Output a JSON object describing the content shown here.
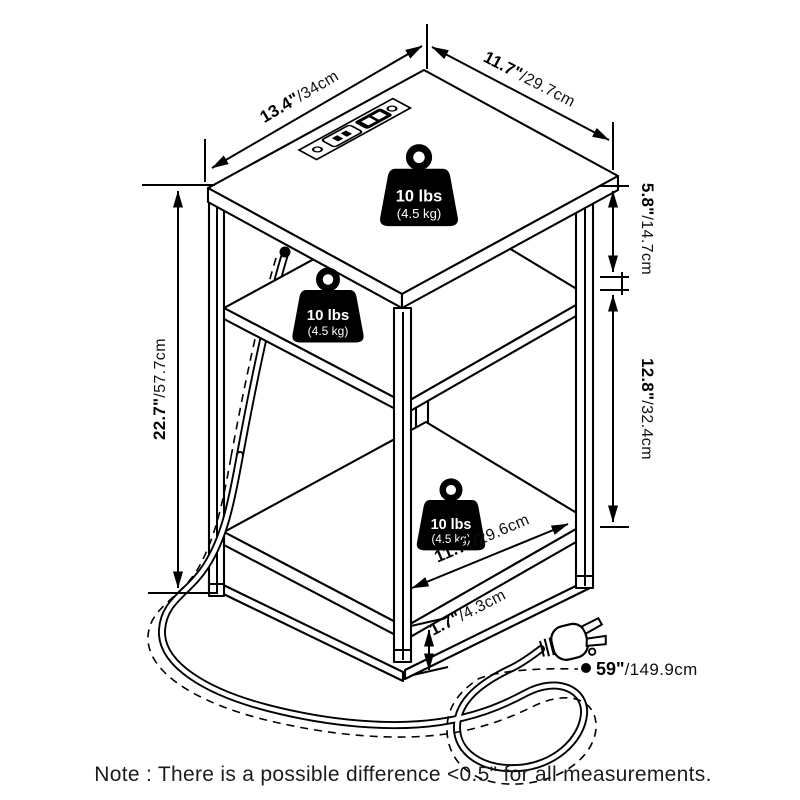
{
  "diagram": {
    "subject": "end table with charging station - dimension drawing",
    "colors": {
      "line": "#000000",
      "background": "#ffffff",
      "text": "#1c1c1c"
    }
  },
  "dimensions": {
    "top_depth": {
      "inches": "13.4\"",
      "cm": "/34cm"
    },
    "top_width": {
      "inches": "11.7\"",
      "cm": "/29.7cm"
    },
    "top_to_middle_shelf": {
      "inches": "5.8\"",
      "cm": "/14.7cm"
    },
    "middle_to_bottom_shelf": {
      "inches": "12.8\"",
      "cm": "/32.4cm"
    },
    "overall_height": {
      "inches": "22.7\"",
      "cm": "/57.7cm"
    },
    "bottom_shelf_depth": {
      "inches": "11.7\"",
      "cm": "/29.6cm"
    },
    "bottom_clearance": {
      "inches": "1.7\"",
      "cm": "/4.3cm"
    },
    "cord_length": {
      "inches": "59\"",
      "cm": "/149.9cm"
    }
  },
  "weight_capacity": {
    "pounds": "10 lbs",
    "kilograms": "(4.5 kg)"
  },
  "note": "Note : There is a possible difference <0.5\" for all measurements."
}
